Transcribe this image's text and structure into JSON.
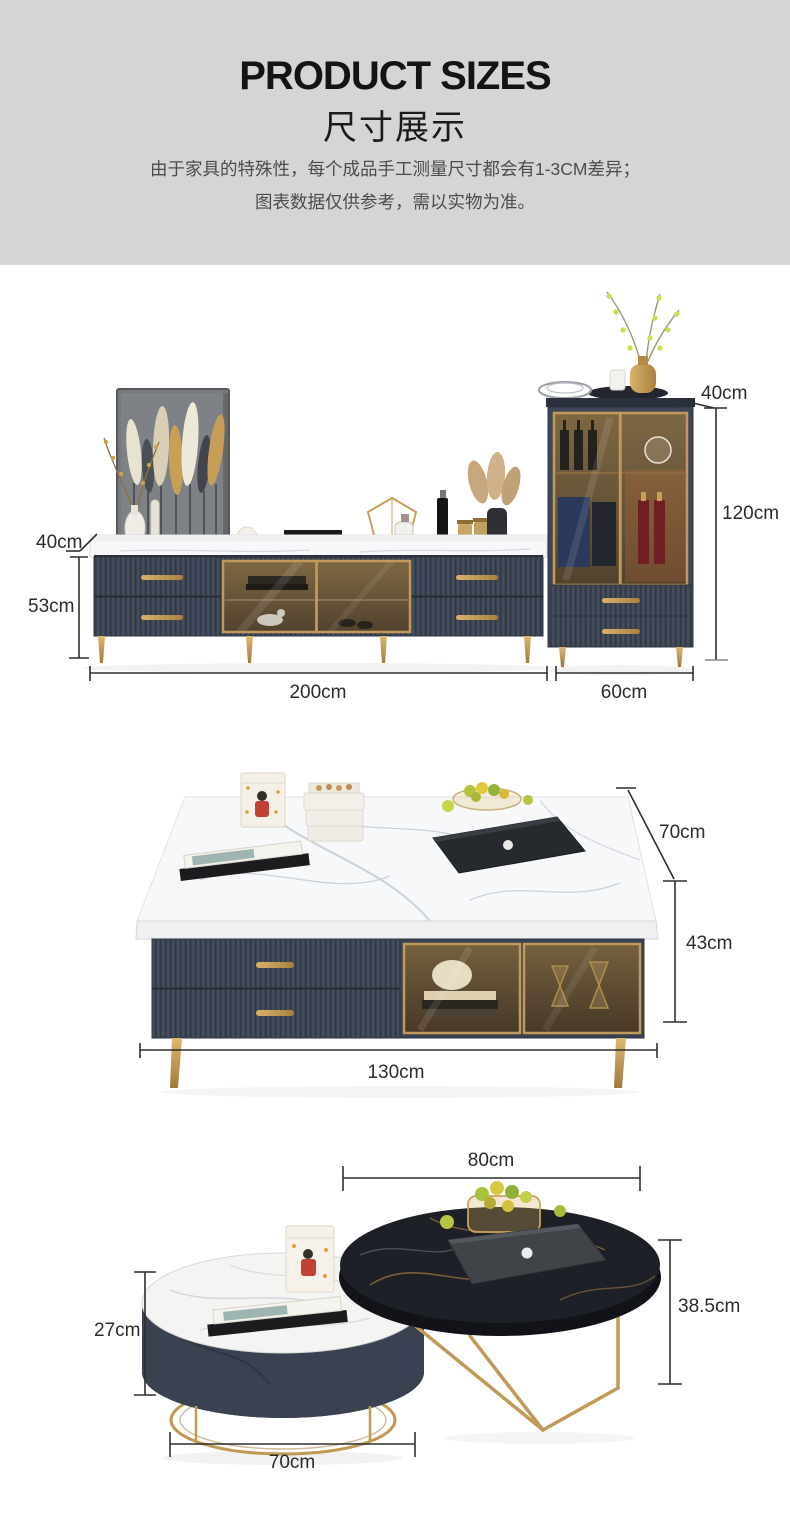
{
  "header": {
    "title": "PRODUCT SIZES",
    "subtitle": "尺寸展示",
    "disclaimer": [
      "由于家具的特殊性，每个成品手工测量尺寸都会有1-3CM差异；",
      "图表数据仅供参考，需以实物为准。"
    ]
  },
  "sections": [
    {
      "id": "tv-stand-and-wine-cabinet",
      "dimensions": {
        "cabinet_depth": "40cm",
        "cabinet_height": "120cm",
        "stand_depth": "40cm",
        "stand_height": "53cm",
        "stand_width": "200cm",
        "cabinet_width": "60cm"
      }
    },
    {
      "id": "coffee-table",
      "dimensions": {
        "depth": "70cm",
        "height": "43cm",
        "width": "130cm"
      }
    },
    {
      "id": "nesting-round-tables",
      "dimensions": {
        "large_diameter": "80cm",
        "large_height": "38.5cm",
        "small_height": "27cm",
        "small_diameter": "70cm"
      }
    }
  ],
  "colors": {
    "header_bg": "#d5d5d5",
    "furniture_body": "#3e4655",
    "accent_gold": "#bf9a55",
    "marble_white": "#f6f7f8",
    "black_marble": "#1d2026",
    "dimension_line": "#2f2f2f",
    "text_primary": "#141414",
    "text_secondary": "#4c4c4c"
  }
}
